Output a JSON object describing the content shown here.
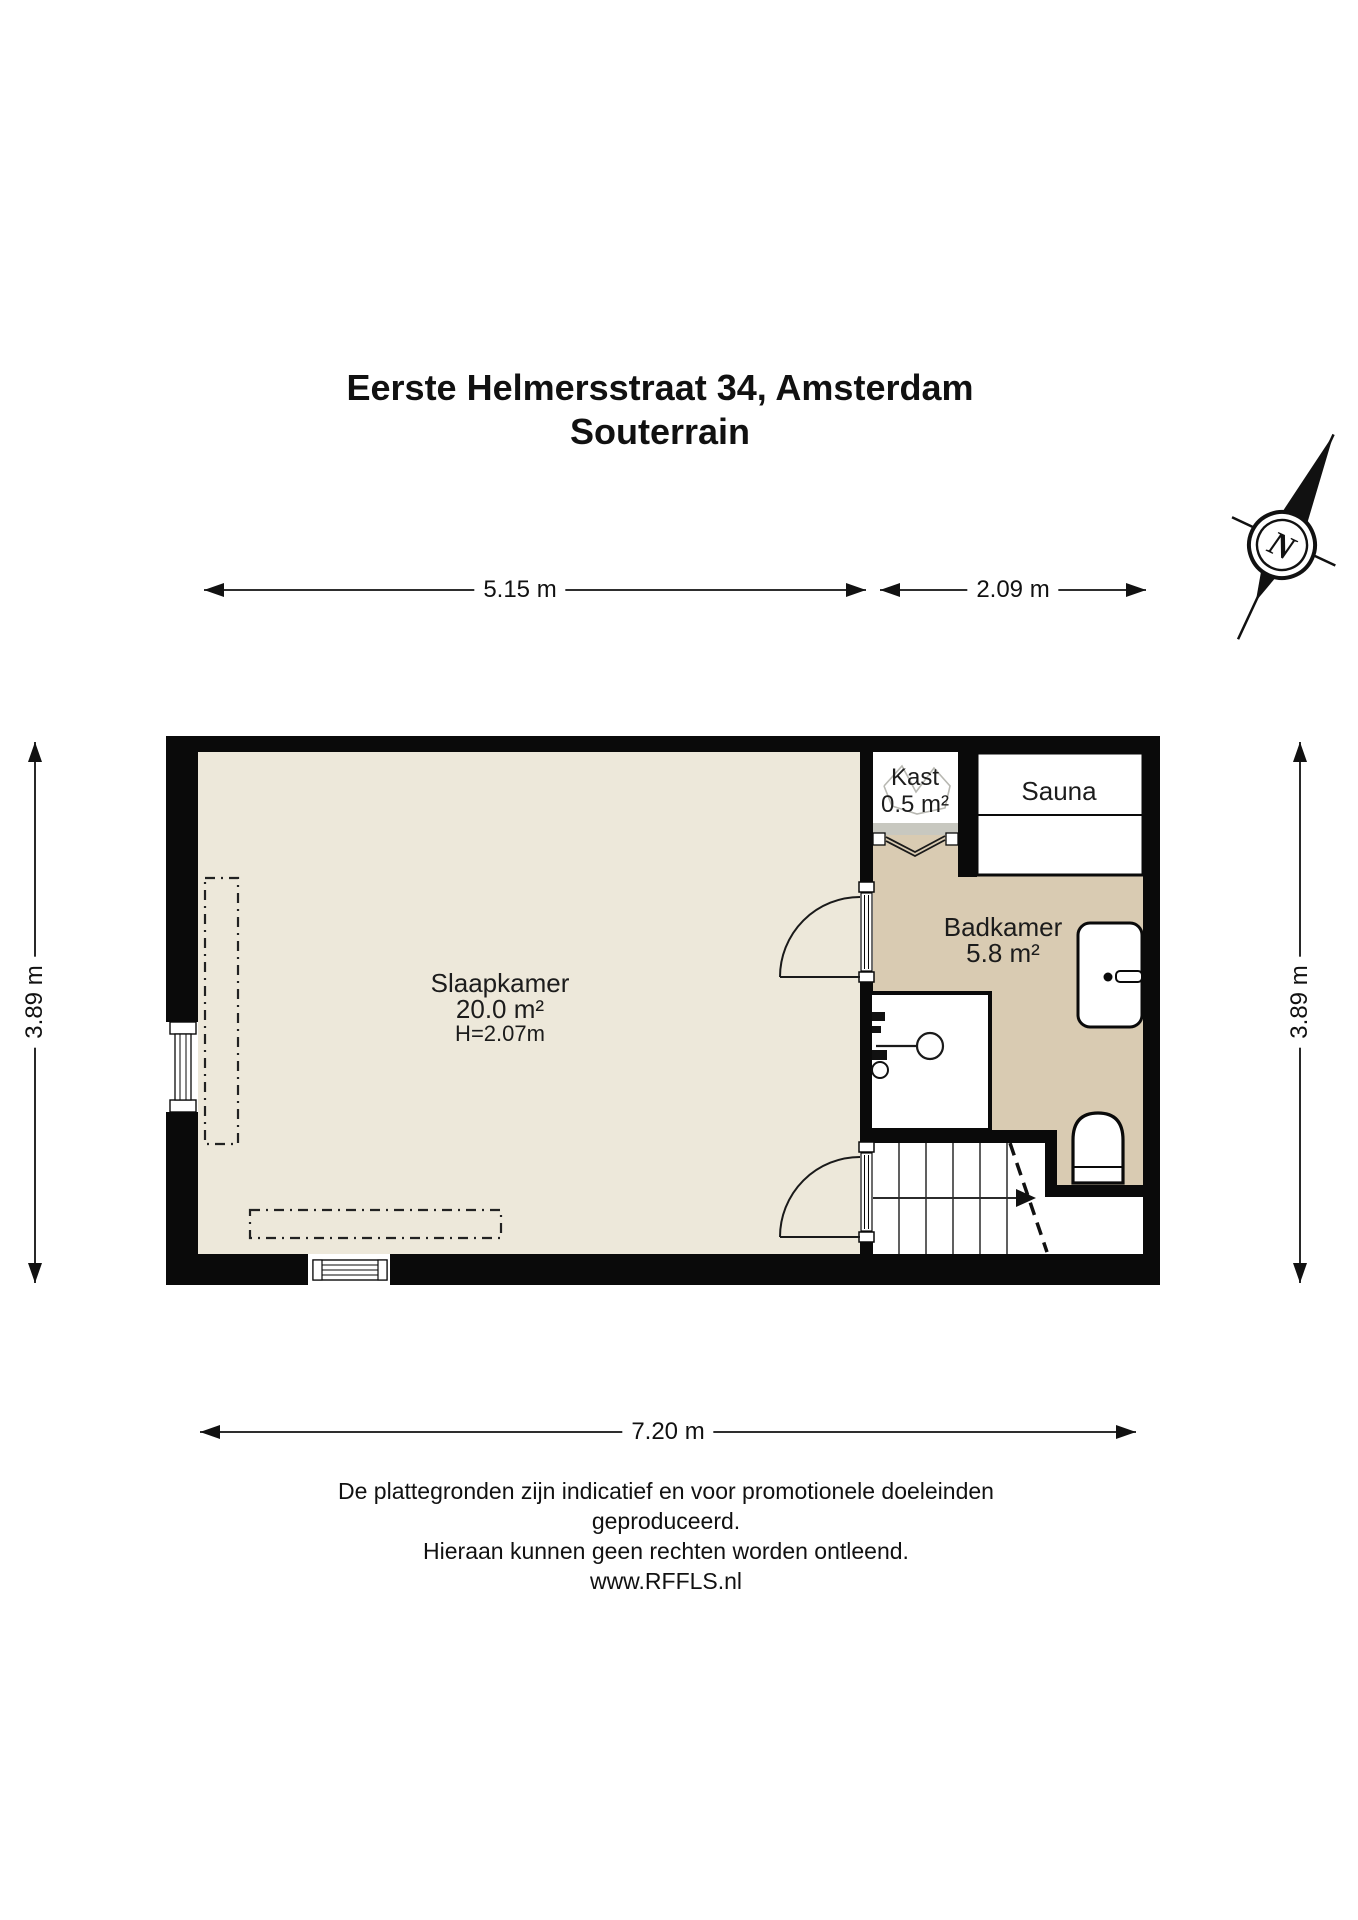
{
  "title": {
    "line1": "Eerste Helmersstraat 34, Amsterdam",
    "line2": "Souterrain"
  },
  "compass": {
    "label": "N"
  },
  "dimensions": {
    "top_left": "5.15 m",
    "top_right": "2.09 m",
    "left": "3.89 m",
    "right": "3.89 m",
    "bottom": "7.20 m"
  },
  "rooms": {
    "slaapkamer": {
      "name": "Slaapkamer",
      "area": "20.0 m²",
      "height": "H=2.07m"
    },
    "badkamer": {
      "name": "Badkamer",
      "area": "5.8 m²"
    },
    "kast": {
      "name": "Kast",
      "area": "0.5 m²"
    },
    "sauna": {
      "name": "Sauna"
    }
  },
  "footer": {
    "line1": "De plattegronden zijn indicatief en voor promotionele doeleinden geproduceerd.",
    "line2": "Hieraan kunnen geen rechten worden ontleend.",
    "line3": "www.RFFLS.nl"
  },
  "colors": {
    "wall": "#0a0a0a",
    "bedroom_floor": "#ede8da",
    "bathroom_floor": "#d9cbb2",
    "threshold": "#c8c8c0",
    "white": "#ffffff"
  }
}
